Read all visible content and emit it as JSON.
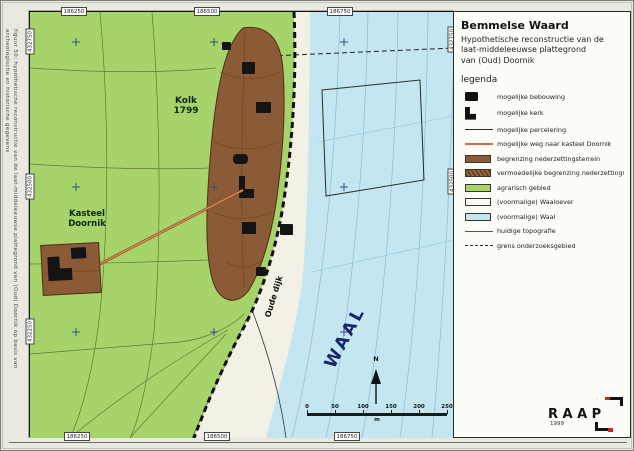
{
  "page": {
    "caption_line1": "figuur 50: hypothetische reconstructie van de laat-middeleeuwse plattegrond van (Oud) Doornik op basis van",
    "caption_line2": "archeologische en historische gegevens"
  },
  "panel": {
    "title": "Bemmelse Waard",
    "subtitle_lines": [
      "Hypothetische reconstructie van de",
      "laat-middeleeuwse plattegrond",
      "van (Oud) Doornik"
    ],
    "legend_heading": "legenda",
    "legend_items": [
      {
        "symbol": "building-icon",
        "label": "mogelijke bebouwing"
      },
      {
        "symbol": "church-icon",
        "label": "mogelijke kerk"
      },
      {
        "symbol": "parcel-line-icon",
        "label": "mogelijke percelering"
      },
      {
        "symbol": "road-line-icon",
        "label": "mogelijke weg naar kasteel Doornik"
      },
      {
        "symbol": "settlement-swatch",
        "label": "begrenzing nederzettingsterrein"
      },
      {
        "symbol": "settlement-probable-swatch",
        "label": "vermoedelijke begrenzing nederzettingsterrein"
      },
      {
        "symbol": "agrarian-swatch",
        "label": "agrarisch gebied"
      },
      {
        "symbol": "riverbank-swatch",
        "label": "(voormalige) Waaloever"
      },
      {
        "symbol": "river-swatch",
        "label": "(voormalige) Waal"
      },
      {
        "symbol": "topography-line-icon",
        "label": "huidige topografie"
      },
      {
        "symbol": "boundary-line-icon",
        "label": "grens onderzoeksgebied"
      }
    ],
    "logo": {
      "text": "RAAP",
      "year": "1999"
    }
  },
  "map": {
    "labels": {
      "kolk_line1": "Kolk",
      "kolk_line2": "1799",
      "kasteel_line1": "Kasteel",
      "kasteel_line2": "Doornik",
      "dike": "Oude dijk",
      "river": "WAAL",
      "north": "N"
    },
    "scalebar": {
      "ticks": [
        "0",
        "50",
        "100",
        "150",
        "200",
        "250"
      ],
      "unit": "m"
    },
    "coordinates": {
      "top": [
        "186250",
        "186500",
        "186750"
      ],
      "bottom": [
        "186250",
        "186500",
        "186750"
      ],
      "left": [
        "432750",
        "432500",
        "432250"
      ],
      "right": [
        "432750",
        "432500"
      ]
    }
  },
  "colors": {
    "agrarian_green": "#a6d36a",
    "settlement_brown": "#8b5a36",
    "river_blue": "#c3e6f1",
    "riverbank_cream": "#f3f0e6",
    "road_red": "#d4694f",
    "logo_accent_red": "#cc2323"
  }
}
